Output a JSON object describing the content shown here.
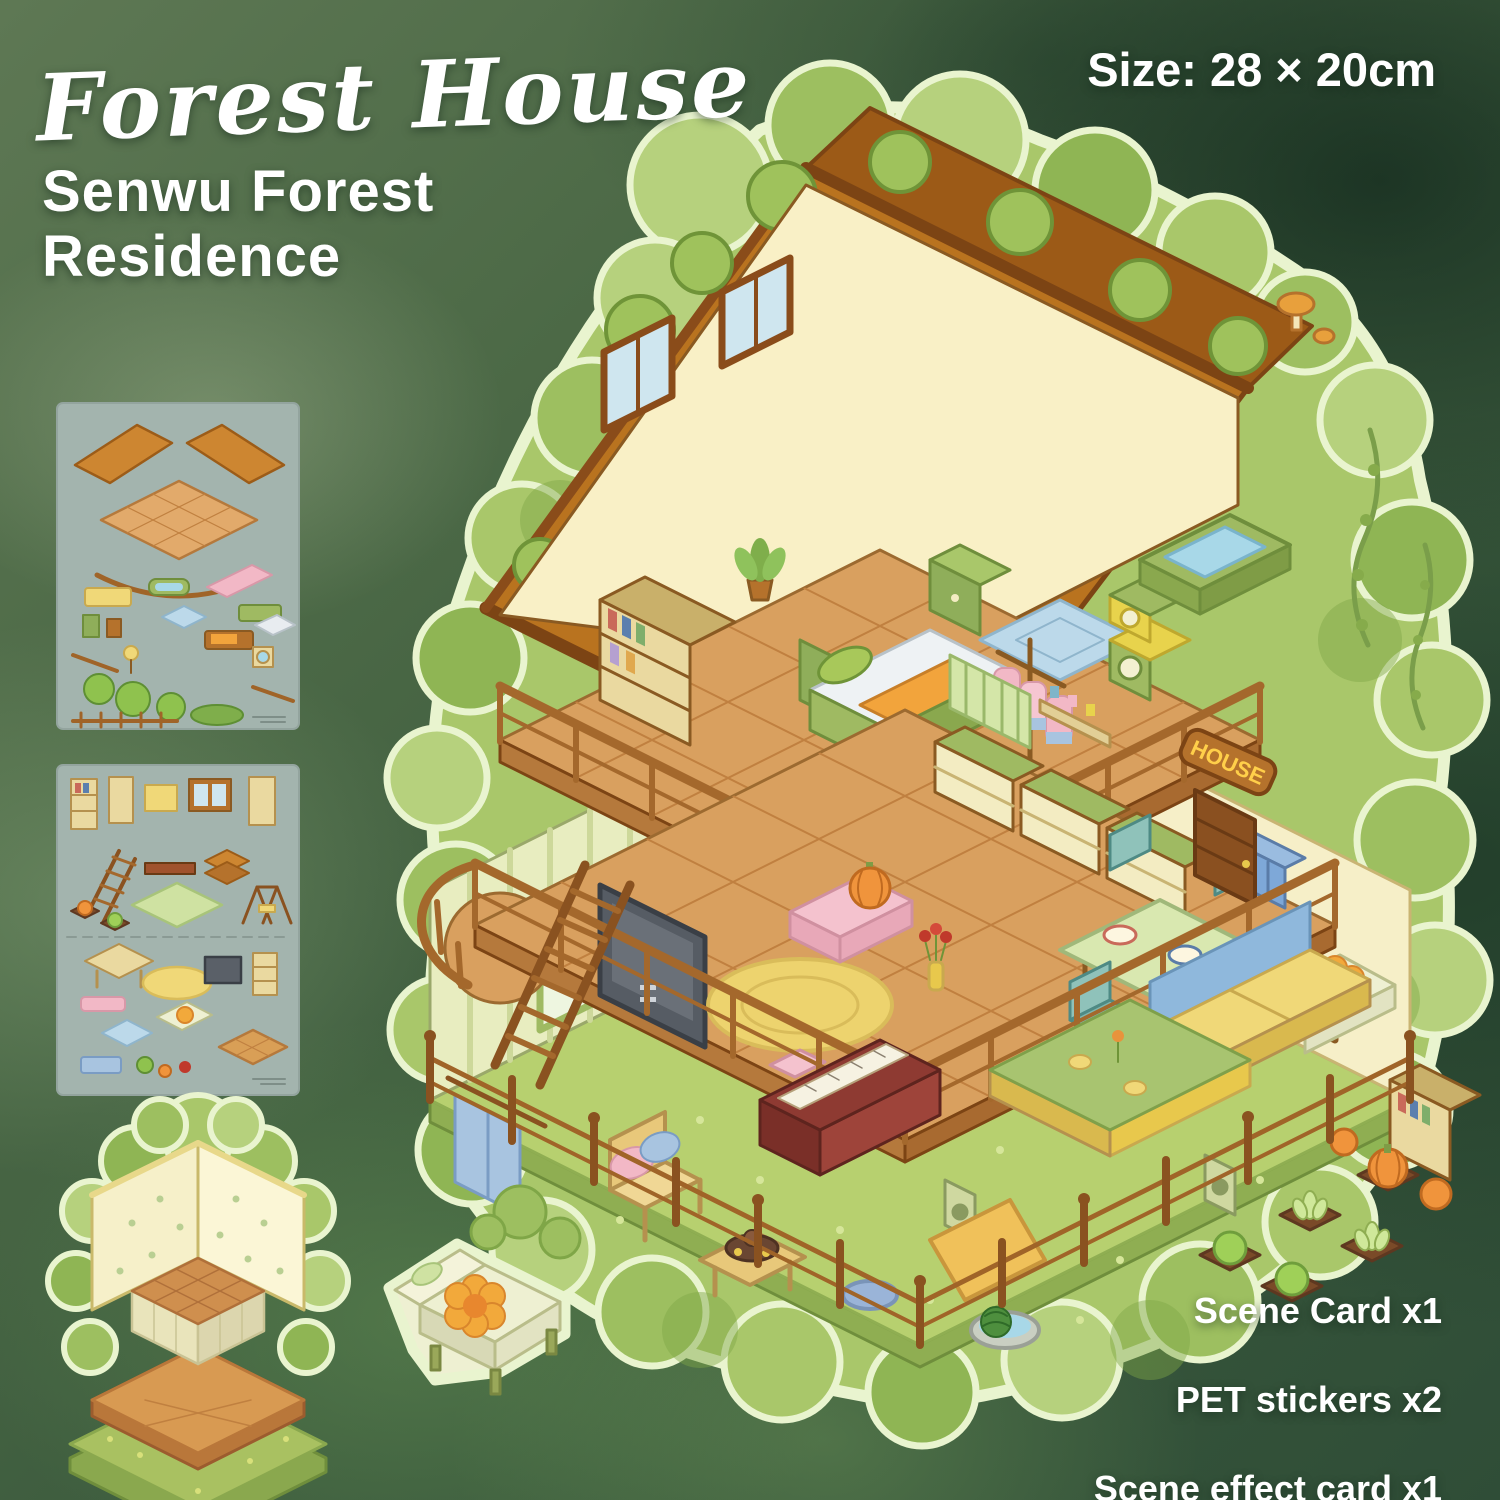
{
  "header": {
    "script_title": "Forest House",
    "subtitle_lines": [
      "Senwu Forest",
      "Residence"
    ],
    "size_label": "Size: 28 × 20cm"
  },
  "contents": {
    "items": [
      {
        "label": "Scene Card x1"
      },
      {
        "label": "PET stickers x2"
      },
      {
        "label": "Scene effect card x1"
      }
    ]
  },
  "illustration": {
    "house_sign": "HOUSE",
    "components": [
      "forest-house-illustration",
      "sticker-sheet-1",
      "sticker-sheet-2",
      "scene-card",
      "lounge-chair-sticker"
    ]
  },
  "colors": {
    "text_white": "#ffffff",
    "background_green_dark": "#2f4d37",
    "background_green_mid": "#4d6a47",
    "roof_brown": "#b9731f",
    "roof_trim": "#7c4414",
    "wall_cream": "#f9f0c6",
    "wood_floor": "#d9a05f",
    "railing_brown": "#a4682c",
    "grass_green": "#b7d06f",
    "bush_green": "#a9c76a",
    "bush_dark": "#8fb554",
    "diecut_edge": "#e9f4cf",
    "sticker_sheet_bg": "#a3b4ae",
    "sign_wood": "#b5722c",
    "sign_text": "#ffcf4a",
    "quilt_orange": "#f2a43c",
    "piano_red": "#8e3a32",
    "water_blue": "#a8d8e8"
  }
}
